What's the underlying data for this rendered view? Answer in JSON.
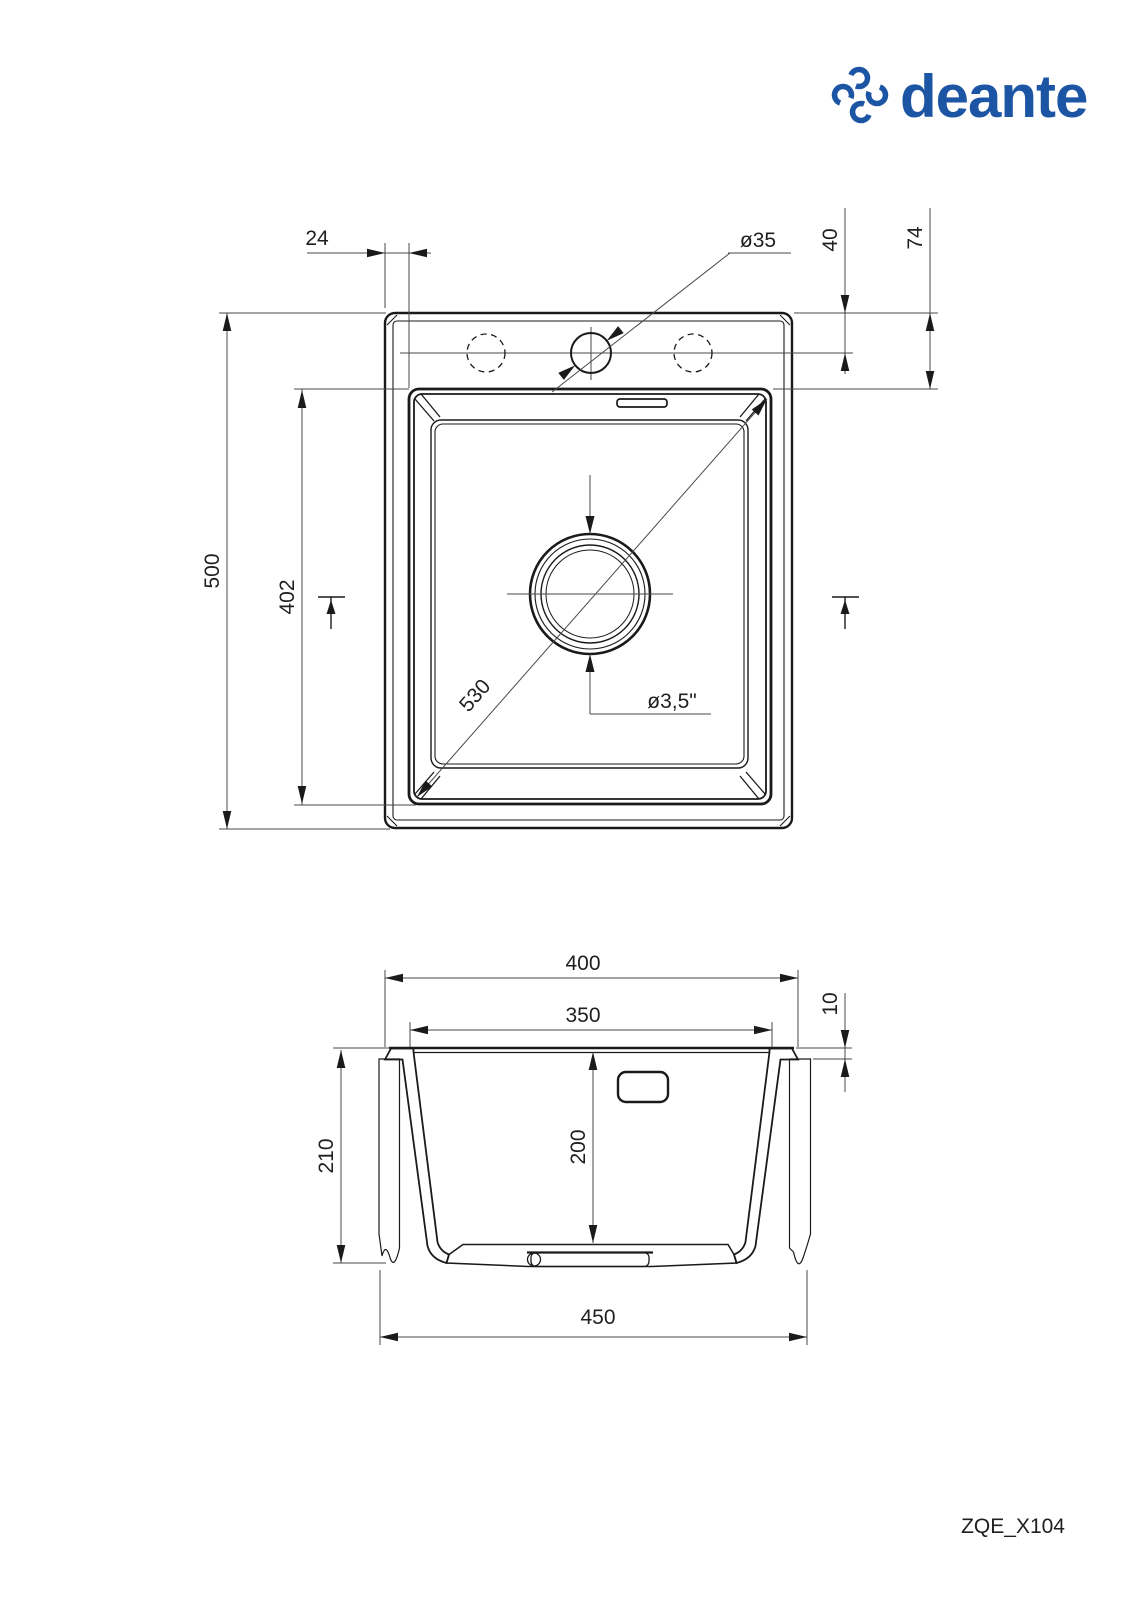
{
  "brand": {
    "name": "deante",
    "color": "#1d55a5"
  },
  "model_code": "ZQE_X104",
  "top_view": {
    "dim_rim_to_bowl": "24",
    "dim_faucet_hole": "ø35",
    "dim_hole_offset": "40",
    "dim_deck_depth": "74",
    "dim_length": "500",
    "dim_bowl_length": "402",
    "dim_diagonal": "530",
    "dim_drain": "ø3,5\""
  },
  "section_view": {
    "dim_width": "400",
    "dim_bowl_width": "350",
    "dim_rim_height": "10",
    "dim_depth_total": "210",
    "dim_bowl_depth": "200",
    "dim_cutout": "450"
  }
}
